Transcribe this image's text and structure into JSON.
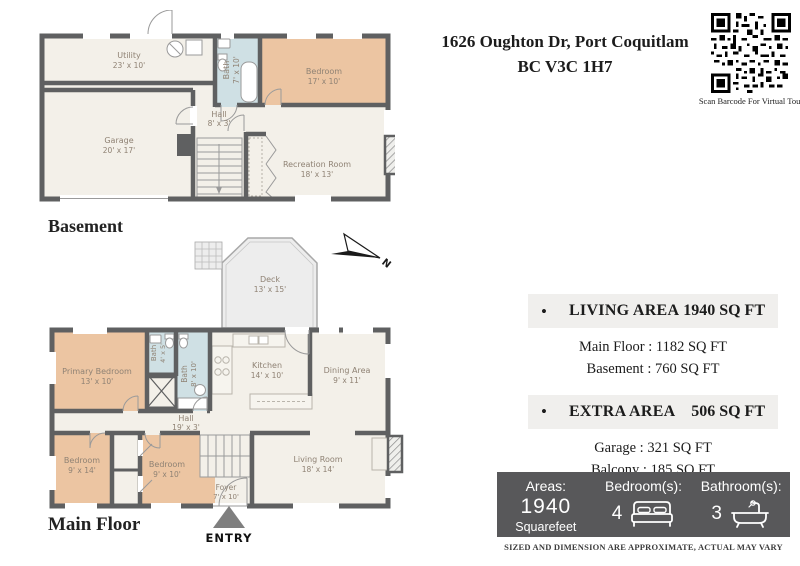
{
  "header": {
    "address_line1": "1626 Oughton Dr, Port Coquitlam",
    "address_line2": "BC V3C 1H7",
    "qr_caption": "Scan Barcode For Virtual Tour"
  },
  "floors": {
    "basement": {
      "label": "Basement",
      "rooms": [
        {
          "name": "Utility",
          "dims": "23' x 10'"
        },
        {
          "name": "Bath",
          "dims": "7' x 10'"
        },
        {
          "name": "Bedroom",
          "dims": "17' x 10'"
        },
        {
          "name": "Garage",
          "dims": "20' x 17'"
        },
        {
          "name": "Hall",
          "dims": "8' x 3'"
        },
        {
          "name": "Recreation Room",
          "dims": "18' x 13'"
        }
      ]
    },
    "main": {
      "label": "Main Floor",
      "entry": "ENTRY",
      "compass": "N",
      "rooms": [
        {
          "name": "Deck",
          "dims": "13' x 15'"
        },
        {
          "name": "Primary Bedroom",
          "dims": "13' x 10'"
        },
        {
          "name": "Bath",
          "dims": "4' x 5'"
        },
        {
          "name": "Bath",
          "dims": "8' x 10'"
        },
        {
          "name": "Kitchen",
          "dims": "14' x 10'"
        },
        {
          "name": "Dining Area",
          "dims": "9' x 11'"
        },
        {
          "name": "Hall",
          "dims": "19' x 3'"
        },
        {
          "name": "Bedroom",
          "dims": "9' x 14'"
        },
        {
          "name": "Bedroom",
          "dims": "9' x 10'"
        },
        {
          "name": "Living Room",
          "dims": "18' x 14'"
        },
        {
          "name": "Foyer",
          "dims": "7' x 10'"
        }
      ]
    }
  },
  "area_summary": {
    "bullet": "•",
    "living": {
      "label": "LIVING AREA",
      "value": "1940 SQ FT",
      "lines": [
        "Main Floor : 1182 SQ FT",
        "Basement : 760 SQ FT"
      ]
    },
    "extra": {
      "label": "EXTRA AREA",
      "value": "506 SQ FT",
      "lines": [
        "Garage : 321 SQ FT",
        "Balcony : 185 SQ FT"
      ]
    }
  },
  "stats_bar": {
    "areas_label": "Areas:",
    "areas_value": "1940",
    "areas_unit": "Squarefeet",
    "bedrooms_label": "Bedroom(s):",
    "bedrooms_value": "4",
    "bathrooms_label": "Bathroom(s):",
    "bathrooms_value": "3"
  },
  "disclaimer": "SIZED AND DIMENSION ARE APPROXIMATE, ACTUAL MAY VARY",
  "colors": {
    "wall": "#5f6061",
    "room_fill": "#f3f0e9",
    "bedroom_fill": "#ecc5a2",
    "bath_fill": "#cfe0e4",
    "deck_fill": "#ededed",
    "stats_bar_bg": "#58585a",
    "summary_row_bg": "#f0efed"
  }
}
